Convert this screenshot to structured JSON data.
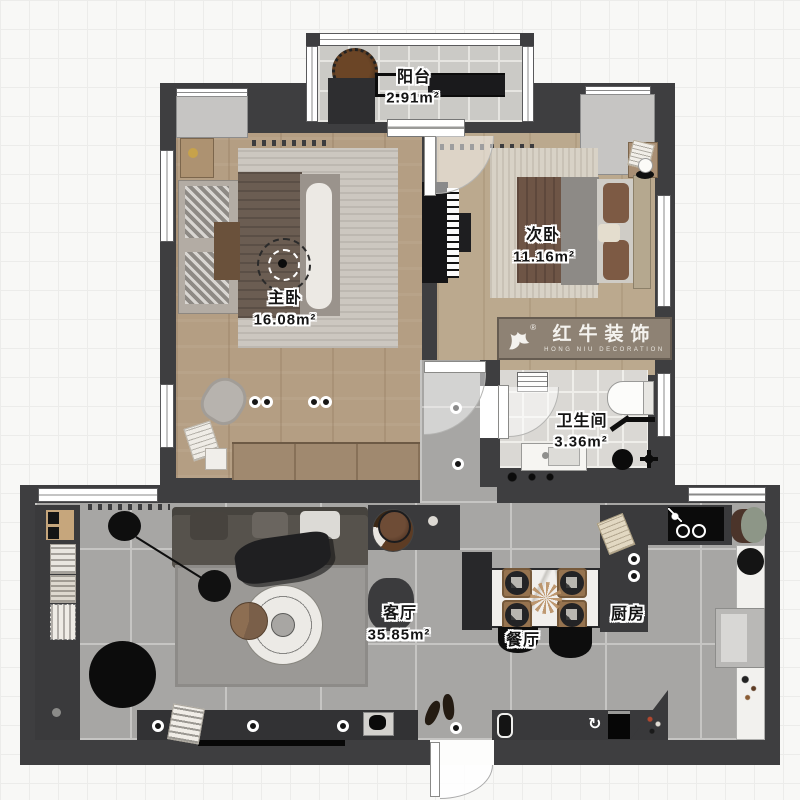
{
  "labels": {
    "balcony": {
      "name": "阳台",
      "area": "2.91m²"
    },
    "master": {
      "name": "主卧",
      "area": "16.08m²"
    },
    "second": {
      "name": "次卧",
      "area": "11.16m²"
    },
    "bathroom": {
      "name": "卫生间",
      "area": "3.36m²"
    },
    "living": {
      "name": "客厅",
      "area": "35.85m²"
    },
    "dining": {
      "name": "餐厅"
    },
    "kitchen": {
      "name": "厨房"
    }
  },
  "logo": {
    "brand": "红牛装饰",
    "subtitle": "HONG NIU DECORATION",
    "registered": "®"
  },
  "icons": {
    "dishwasher_rotate": "↻"
  },
  "palette": {
    "wall": "#3e3e40",
    "wood_floor": "#b49e83",
    "wardrobe_wood": "#a0896f",
    "living_tile": "#a7a6a4",
    "balcony_tile": "#cbcac6",
    "bath_tile": "#dad8d4",
    "logo_banner": "#8e8274",
    "background": "#f8f8f6"
  }
}
